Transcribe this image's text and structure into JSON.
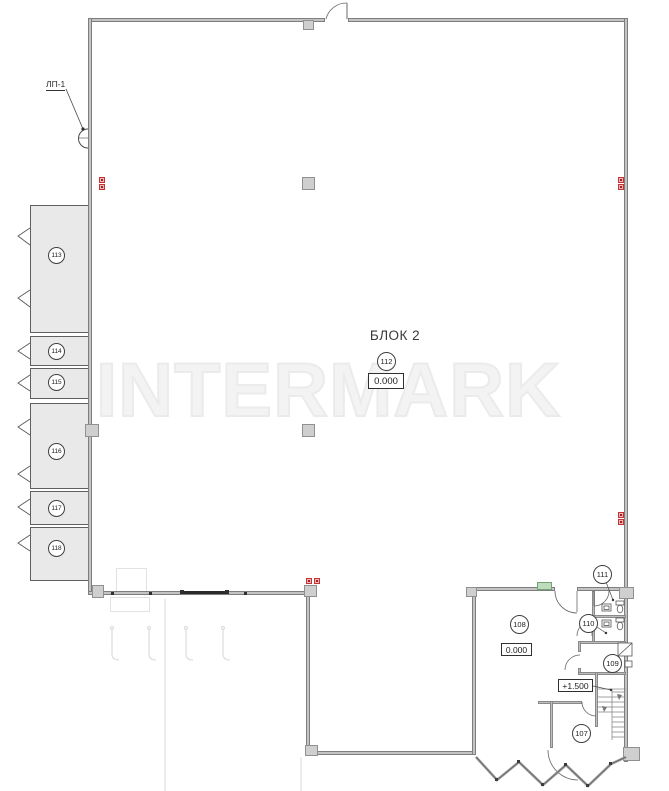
{
  "watermark": "INTERMARK",
  "labels": {
    "block_title": "БЛОК 2",
    "stair_tag": "ЛП-1",
    "elevation_main": "0.000",
    "elevation_room108": "0.000",
    "elevation_mezzanine": "+1.500"
  },
  "rooms": {
    "hall": {
      "number": "112"
    },
    "left": [
      {
        "number": "113"
      },
      {
        "number": "114"
      },
      {
        "number": "115"
      },
      {
        "number": "116"
      },
      {
        "number": "117"
      },
      {
        "number": "118"
      }
    ],
    "annex": [
      {
        "number": "108"
      },
      {
        "number": "111"
      },
      {
        "number": "110"
      },
      {
        "number": "109"
      },
      {
        "number": "107"
      }
    ]
  },
  "colors": {
    "wall": "#c4c4c4",
    "room_fill": "#e9e9e9",
    "section_marker_red": "#c23434",
    "lintel_marker_green": "#bcdcbc",
    "line": "#4a4a4a",
    "watermark": "#f3f3f3"
  }
}
